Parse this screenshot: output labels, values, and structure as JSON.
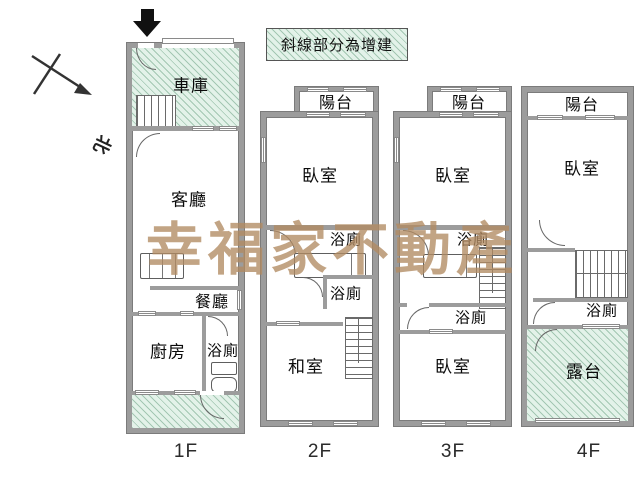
{
  "legend": {
    "text": "斜線部分為增建"
  },
  "compass": {
    "label": "北"
  },
  "watermark": {
    "text": "幸福家不動產",
    "color": "#b28b62"
  },
  "colors": {
    "wall": "#9c9c9c",
    "wall_edge": "#7b7b7b",
    "hatch_bg": "#e3f2e9",
    "hatch_line": "#7daa8e"
  },
  "floors": [
    {
      "label": "1F",
      "rooms": {
        "garage": "車庫",
        "living_room": "客廳",
        "dining_room": "餐廳",
        "kitchen": "廚房",
        "bathroom": "浴廁"
      }
    },
    {
      "label": "2F",
      "rooms": {
        "balcony": "陽台",
        "bedroom": "臥室",
        "bathroom_upper": "浴廁",
        "bathroom_lower": "浴廁",
        "tatami_room": "和室"
      }
    },
    {
      "label": "3F",
      "rooms": {
        "balcony": "陽台",
        "bedroom_front": "臥室",
        "bathroom_upper": "浴廁",
        "bathroom_lower": "浴廁",
        "bedroom_rear": "臥室"
      }
    },
    {
      "label": "4F",
      "rooms": {
        "balcony": "陽台",
        "bedroom": "臥室",
        "bathroom": "浴廁",
        "terrace": "露台"
      }
    }
  ]
}
